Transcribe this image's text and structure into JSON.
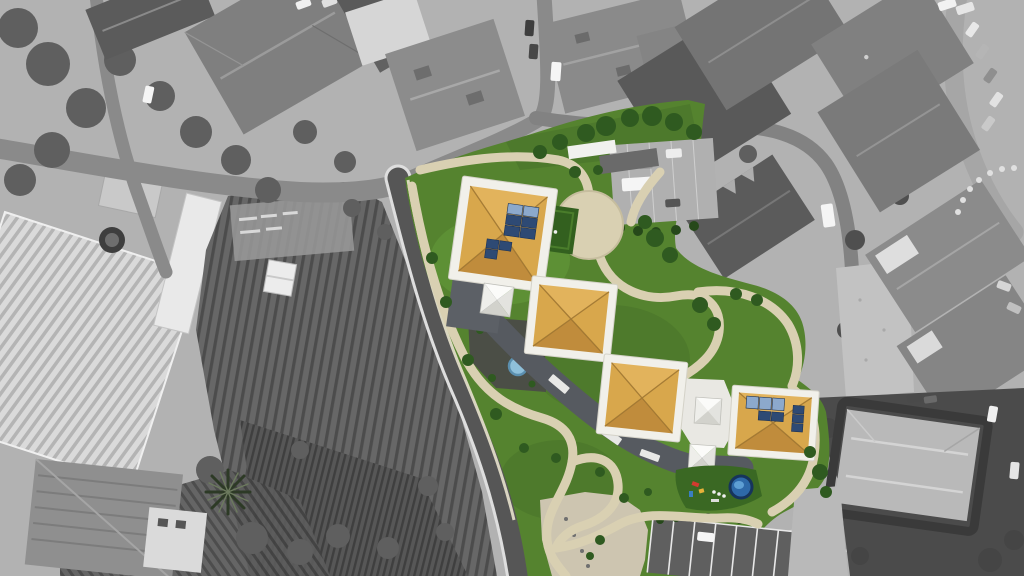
{
  "image": {
    "kind": "aerial-drone-photograph",
    "technique": "selective-color architectural composite: grayscale surroundings, full-color proposed development",
    "orientation": "top-down nadir view"
  },
  "palette": {
    "base_gray": "#b2b2b2",
    "veg_gray": "#5f5f5f",
    "veg_gray_dark": "#454545",
    "field_gray": "#676767",
    "field_line": "#4c4c4c",
    "greenhouse_light": "#dadada",
    "greenhouse_line": "#b4b4b4",
    "road_dark": "#565656",
    "road_mid": "#8a8a8a",
    "road_light": "#a6a6a6",
    "edge_white": "#dedede",
    "roof_gray_dark": "#5b5b5b",
    "roof_gray": "#7f7f7f",
    "roof_gray_light": "#b9b9b9",
    "white_structure": "#f1f0ea",
    "grass": "#55832f",
    "grass_light": "#649a3a",
    "grass_dark": "#47712a",
    "turf": "#3a6823",
    "tree_green": "#2f5a20",
    "tree_green_dark": "#26481a",
    "roof_orange": "#d8a74c",
    "roof_orange_light": "#e2b35c",
    "roof_orange_shade": "#c08c3c",
    "roof_ridge": "#9c732f",
    "path_beige": "#d9d0b2",
    "plaza_beige": "#cdc5b0",
    "curb_beige": "#e8e2cd",
    "connector_gray": "#565a60",
    "solar_dark": "#2e4a74",
    "solar_light": "#8ca9cc",
    "pool_water": "#8fc0da",
    "pool_rim": "#5b8fae",
    "play_pool": "#2e69a8",
    "play_pool_rim": "#16345c",
    "car_white": "#f5f5f5",
    "car_dark": "#3e3e3e",
    "car_gray": "#9a9a9a"
  },
  "scene": {
    "grayscale_context": [
      "dense residential blocks with gray hipped roofs (top and right)",
      "curving streets with white edge lines and parked cars",
      "large greenhouses with ribbed roofs (left)",
      "cultivated garden plots with furrow rows (left and bottom-left)",
      "palm tree and farmhouse (bottom-left)",
      "gravel lot and villa with white terraces (right)",
      "light roofed villa with hedge ring (bottom-right)"
    ],
    "highlighted_site": {
      "lawn": "vivid green landscaped grounds bounded by the curving street",
      "pavilions": [
        {
          "id": 1,
          "roof": "orange hip roof with white parapet",
          "solar_panels": true
        },
        {
          "id": 2,
          "roof": "orange hip roof with white parapet",
          "solar_panels": false
        },
        {
          "id": 3,
          "roof": "orange hip roof with white parapet",
          "solar_panels": false
        },
        {
          "id": 4,
          "roof": "orange hip roof with white parapet",
          "solar_panels": true
        }
      ],
      "features": [
        "circular beige plaza",
        "winding beige footpaths",
        "white pyramid skylights",
        "dark flat-roof connecting corridor",
        "courtyard with small round pool",
        "playground with round blue pool and play equipment",
        "parking court with white stall lines and parked car",
        "small green sports court",
        "street-side parking lot with white van",
        "colored trees and shrubs along paths"
      ]
    }
  }
}
